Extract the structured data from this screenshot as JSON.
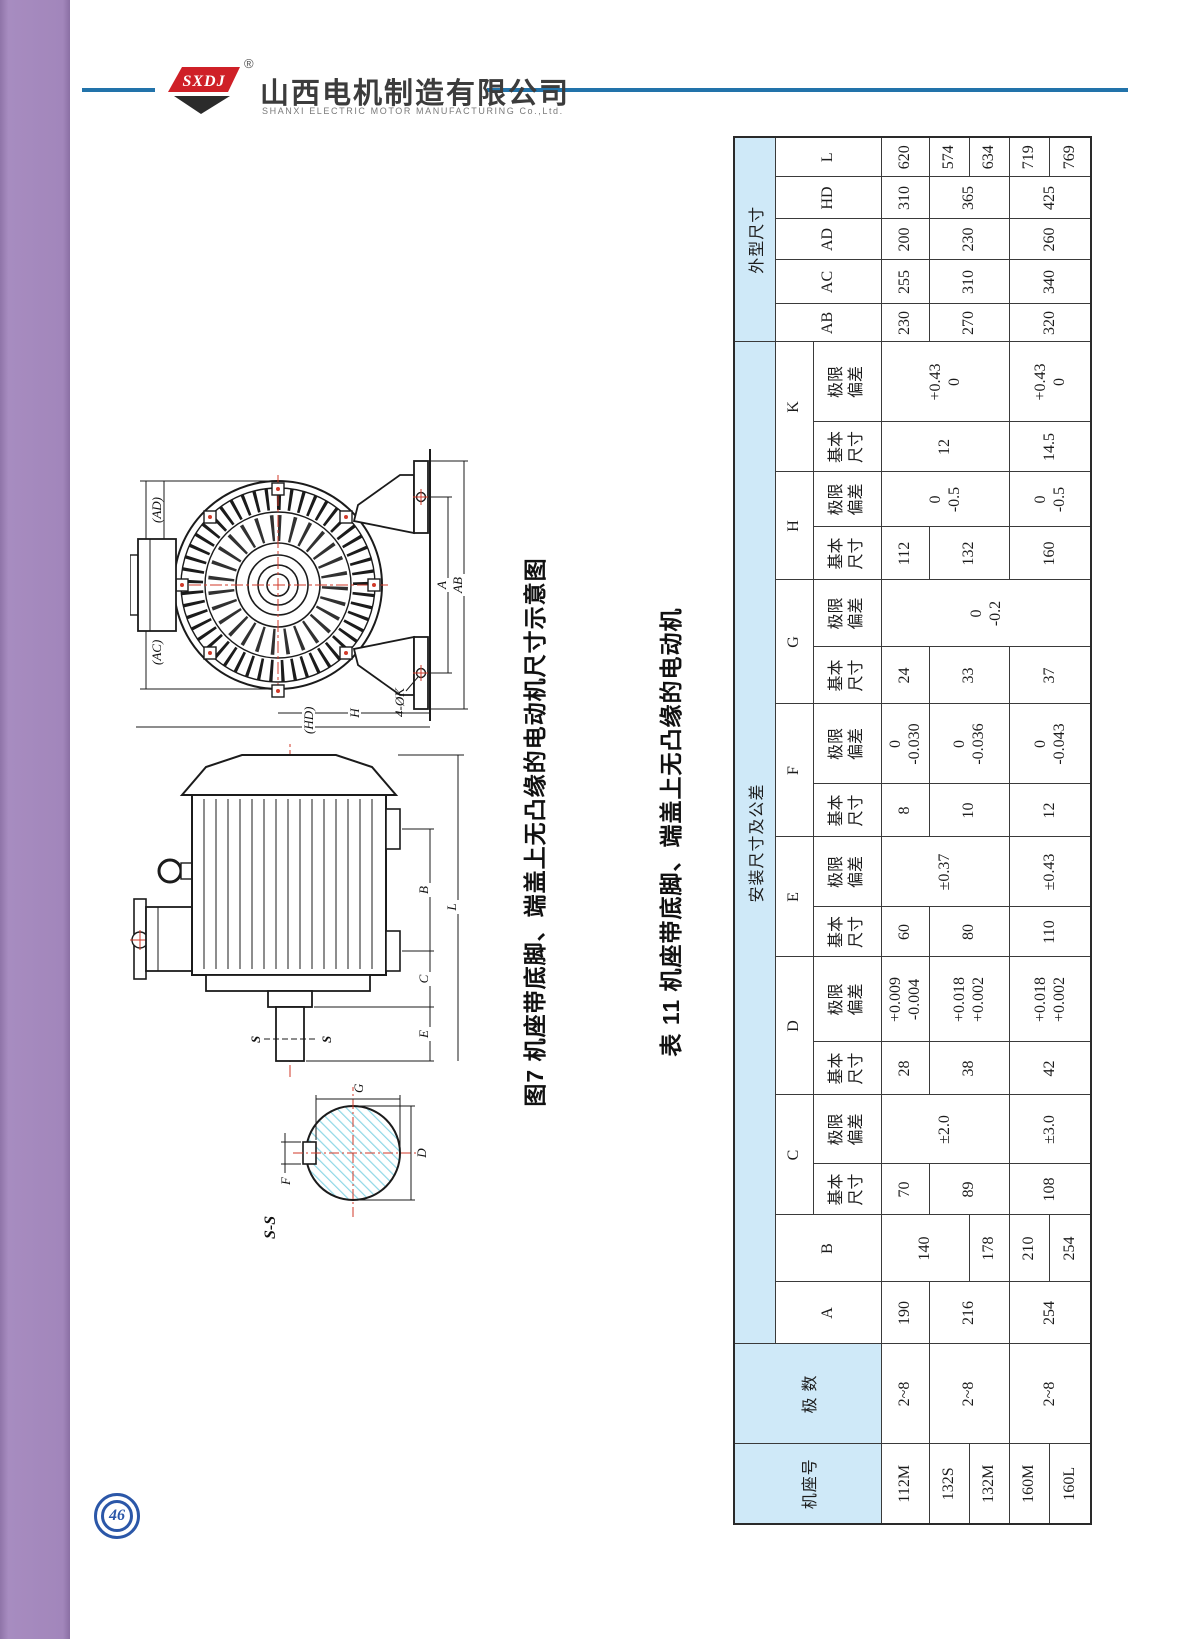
{
  "header": {
    "logo_text": "SXDJ",
    "reg_mark": "®",
    "company_cn": "山西电机制造有限公司",
    "company_en": "SHANXI  ELECTRIC  MOTOR  MANUFACTURING  Co.,Ltd."
  },
  "page": {
    "number": "46"
  },
  "figure": {
    "caption": "图7 机座带底脚、端盖上无凸缘的电动机尺寸示意图",
    "labels": {
      "ss": "S-S",
      "f": "F",
      "g": "G",
      "d": "D",
      "s1": "S",
      "s2": "S",
      "e": "E",
      "c": "C",
      "b": "B",
      "l": "L",
      "hd": "(HD)",
      "ac": "(AC)",
      "ad": "(AD)",
      "a": "A",
      "ab": "AB",
      "h": "H",
      "k4": "4-ØK"
    }
  },
  "table": {
    "title": "表 11 机座带底脚、端盖上无凸缘的电动机",
    "headers": {
      "frame": "机座号",
      "poles": "极 数",
      "install_group": "安装尺寸及公差",
      "outline_group": "外型尺寸",
      "basic": "基本\n尺寸",
      "tol": "极限\n偏差",
      "A": "A",
      "B": "B",
      "C": "C",
      "D": "D",
      "E": "E",
      "F": "F",
      "G": "G",
      "H": "H",
      "K": "K",
      "AB": "AB",
      "AC": "AC",
      "AD": "AD",
      "HD": "HD",
      "L": "L"
    },
    "frames": [
      "112M",
      "132S",
      "132M",
      "160M",
      "160L"
    ],
    "poles": [
      "2~8",
      "2~8",
      "2~8"
    ],
    "A": [
      "190",
      "216",
      "254"
    ],
    "B": [
      "140",
      "178",
      "210",
      "254"
    ],
    "C_basic": [
      "70",
      "89",
      "108"
    ],
    "C_tol": [
      "±2.0",
      "±3.0"
    ],
    "D_basic": [
      "28",
      "38",
      "42"
    ],
    "D_tol": [
      "+0.009\n-0.004",
      "+0.018\n+0.002",
      "+0.018\n+0.002"
    ],
    "E_basic": [
      "60",
      "80",
      "110"
    ],
    "E_tol": [
      "±0.37",
      "±0.43"
    ],
    "F_basic": [
      "8",
      "10",
      "12"
    ],
    "F_tol": [
      "0\n-0.030",
      "0\n-0.036",
      "0\n-0.043"
    ],
    "G_basic": [
      "24",
      "33",
      "37"
    ],
    "G_tol": [
      "0\n-0.2"
    ],
    "H_basic": [
      "112",
      "132",
      "160"
    ],
    "H_tol": [
      "0\n-0.5",
      "0\n-0.5"
    ],
    "K_basic": [
      "12",
      "14.5"
    ],
    "K_tol": [
      "+0.43\n0",
      "+0.43\n0"
    ],
    "AB": [
      "230",
      "270",
      "320"
    ],
    "AC": [
      "255",
      "310",
      "340"
    ],
    "AD": [
      "200",
      "230",
      "260"
    ],
    "HD": [
      "310",
      "365",
      "425"
    ],
    "L": [
      "620",
      "574",
      "634",
      "719",
      "769"
    ]
  }
}
